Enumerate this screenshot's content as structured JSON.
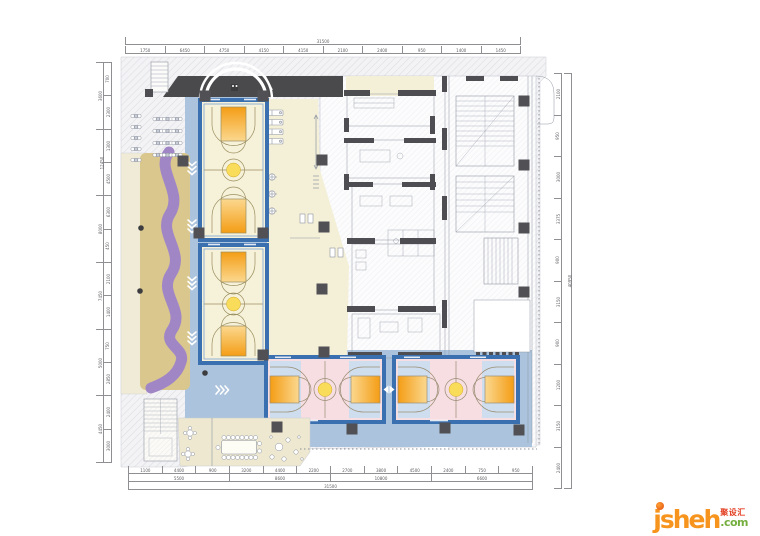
{
  "logo": {
    "brand": "jsheh",
    "cn": "聚设汇",
    "tld": ".com",
    "brand_color": "#f7941d",
    "cn_color": "#e23b1e",
    "tld_color": "#74ae3e"
  },
  "colors": {
    "circulation_blue": "#abc3dc",
    "court_frame_blue": "#3a6fb0",
    "court_cream": "#f6f1d9",
    "court_pink": "#f7dee2",
    "court_end_blue": "#cfdeee",
    "key_orange_dark": "#f49d15",
    "key_orange_light": "#fbd88f",
    "center_ball_yellow": "#f8dc5a",
    "track_purple": "#a186c6",
    "play_tan": "#d9c78e",
    "cream_strip": "#f0ebd7",
    "gym_cream": "#f4f0d8",
    "cafe_cream": "#eee8d0",
    "canopy_dark": "#4a4a4d",
    "wall_dark": "#4e4e52",
    "line_gray": "#9096a1"
  },
  "dimensions": {
    "top_outer": [
      "31500"
    ],
    "top_inner": [
      "1750",
      "6450",
      "4750",
      "4150",
      "4150",
      "2100",
      "2400",
      "950",
      "1400",
      "1450"
    ],
    "left_outer": [
      "3600",
      "12450",
      "8000",
      "7450",
      "5000",
      "4450"
    ],
    "left_inner": [
      "700",
      "2300",
      "1300",
      "4500",
      "6300",
      "450",
      "2100",
      "1400",
      "750",
      "2850",
      "2400",
      "3000"
    ],
    "right_outer": [
      "40950"
    ],
    "right_inner": [
      "2100",
      "950",
      "3000",
      "3375",
      "900",
      "3150",
      "900",
      "1200",
      "3150",
      "2400"
    ],
    "bottom_inner": [
      "1100",
      "4400",
      "900",
      "3200",
      "4400",
      "2200",
      "2700",
      "3800",
      "4500",
      "2400",
      "750",
      "950"
    ],
    "bottom_mid": [
      "5500",
      "8600",
      "10800",
      "6600"
    ],
    "bottom_outer": [
      "31500"
    ]
  }
}
